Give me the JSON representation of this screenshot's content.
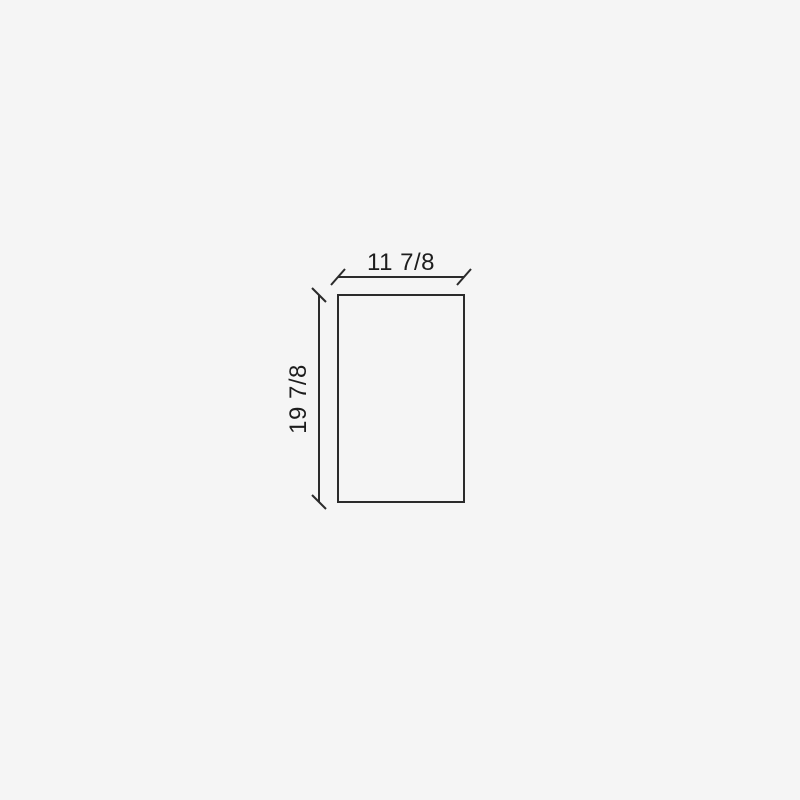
{
  "drawing": {
    "width_label": "11 7/8",
    "height_label": "19 7/8",
    "background_color": "#f5f5f5",
    "line_color": "#2b2b2b",
    "text_color": "#1d1d1d"
  }
}
